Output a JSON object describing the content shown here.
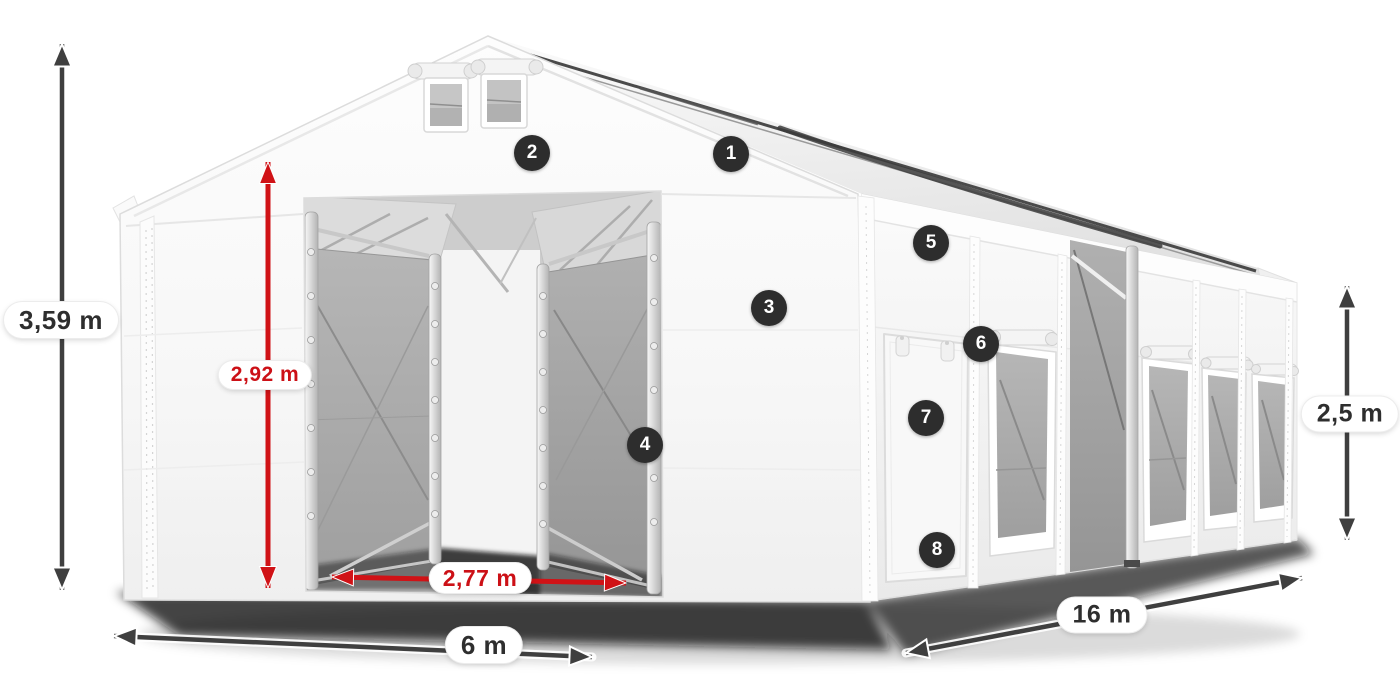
{
  "page": {
    "background": "#ffffff",
    "illustration": "3D render of a white PVC storage tent (marquee) with open front gate, interior mesh partition gates, side door and mesh windows"
  },
  "colors": {
    "dimension_dark": "#3f3f3f",
    "dimension_red": "#d01216",
    "label_background": "#ffffff",
    "label_text_dark": "#2e2e2e",
    "label_text_red": "#cc1016",
    "badge_background": "#2d2d2d",
    "badge_text": "#ffffff",
    "tent_fabric": "#f7f7f7",
    "mesh_panel": "#ababab"
  },
  "dimensions": {
    "total_height": {
      "label": "3,59 m",
      "color": "dark",
      "orientation": "vertical"
    },
    "entrance_height": {
      "label": "2,92 m",
      "color": "red",
      "orientation": "vertical"
    },
    "entrance_width": {
      "label": "2,77 m",
      "color": "red",
      "orientation": "horizontal"
    },
    "front_width": {
      "label": "6 m",
      "color": "dark",
      "orientation": "horizontal"
    },
    "side_length": {
      "label": "16 m",
      "color": "dark",
      "orientation": "diagonal"
    },
    "side_height": {
      "label": "2,5 m",
      "color": "dark",
      "orientation": "vertical"
    }
  },
  "badges": [
    {
      "number": "1"
    },
    {
      "number": "2"
    },
    {
      "number": "3"
    },
    {
      "number": "4"
    },
    {
      "number": "5"
    },
    {
      "number": "6"
    },
    {
      "number": "7"
    },
    {
      "number": "8"
    }
  ]
}
